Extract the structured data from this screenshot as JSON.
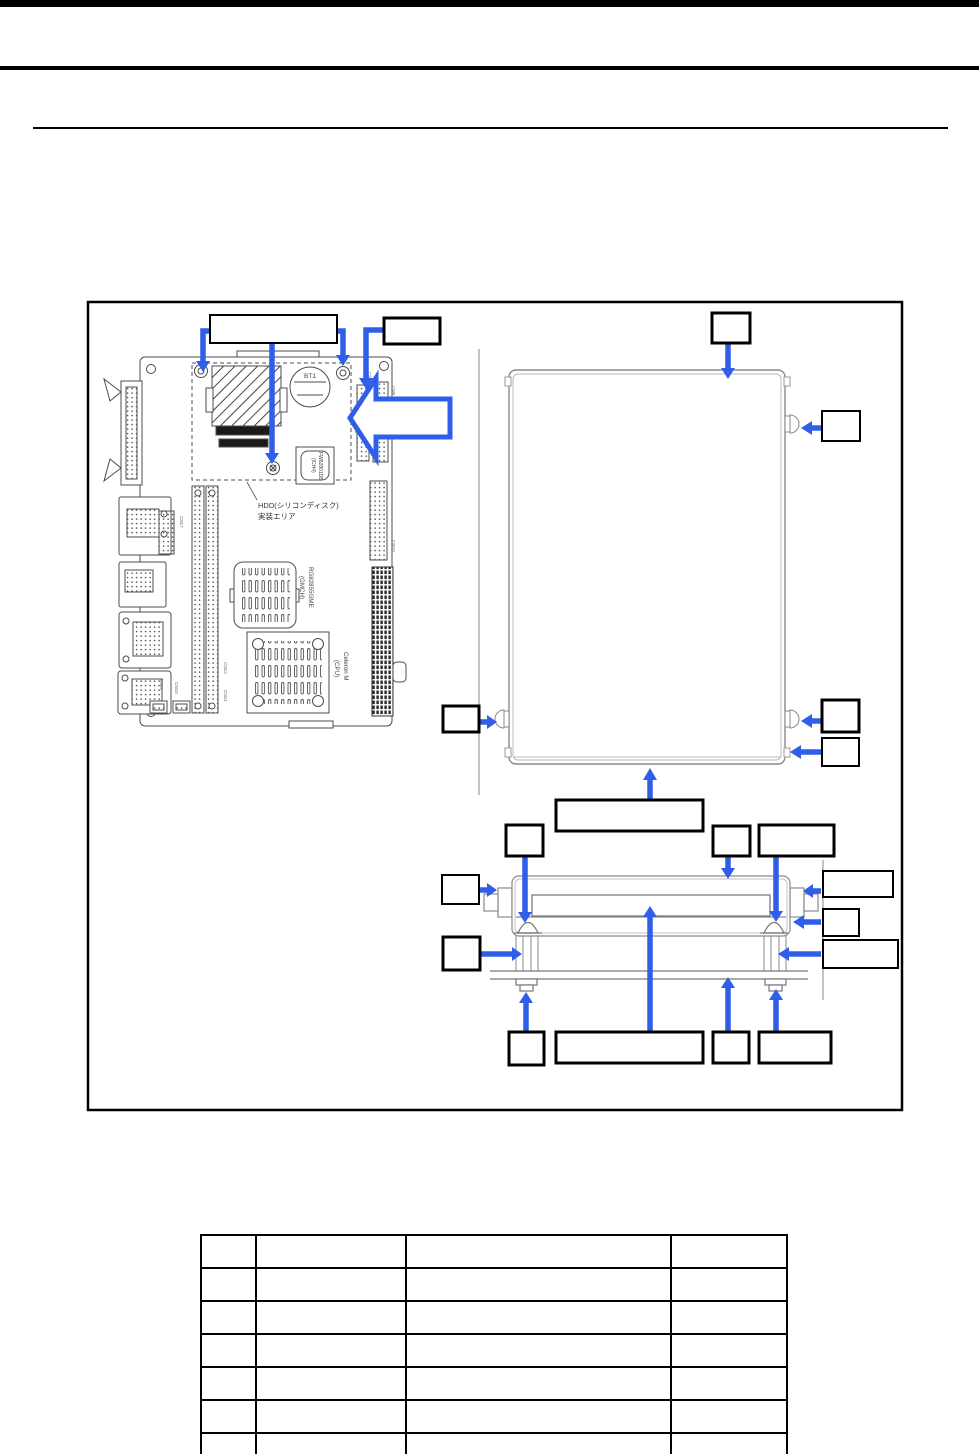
{
  "colors": {
    "arrow_blue": "#2f5fe8"
  },
  "figure": {
    "pcb": {
      "battery_label": "BT1",
      "hdd_area_line1": "HDD(シリコンディスク)",
      "hdd_area_line2": "実装エリア",
      "gmch_line1": "RG82855GME",
      "gmch_line2": "(GMCH)",
      "cpu_line1": "Celeron M",
      "cpu_line2": "(CPU)",
      "ich_line1": "FW82801DB",
      "ich_line2": "(ICH4)",
      "connector_labels": {
        "cn2": "CN2",
        "cn3": "CN3",
        "cn9": "CN9",
        "cn10": "CN10",
        "cn11": "CN11",
        "cn12": "CN12",
        "cn14": "CN14",
        "cn15": "CN15",
        "cn17": "CN17"
      }
    },
    "callout_text": ""
  },
  "table": {
    "rows": [
      [
        "",
        "",
        "",
        ""
      ],
      [
        "",
        "",
        "",
        ""
      ],
      [
        "",
        "",
        "",
        ""
      ],
      [
        "",
        "",
        "",
        ""
      ],
      [
        "",
        "",
        "",
        ""
      ],
      [
        "",
        "",
        "",
        ""
      ],
      [
        "",
        "",
        "",
        ""
      ],
      [
        "",
        "",
        "",
        ""
      ]
    ]
  }
}
